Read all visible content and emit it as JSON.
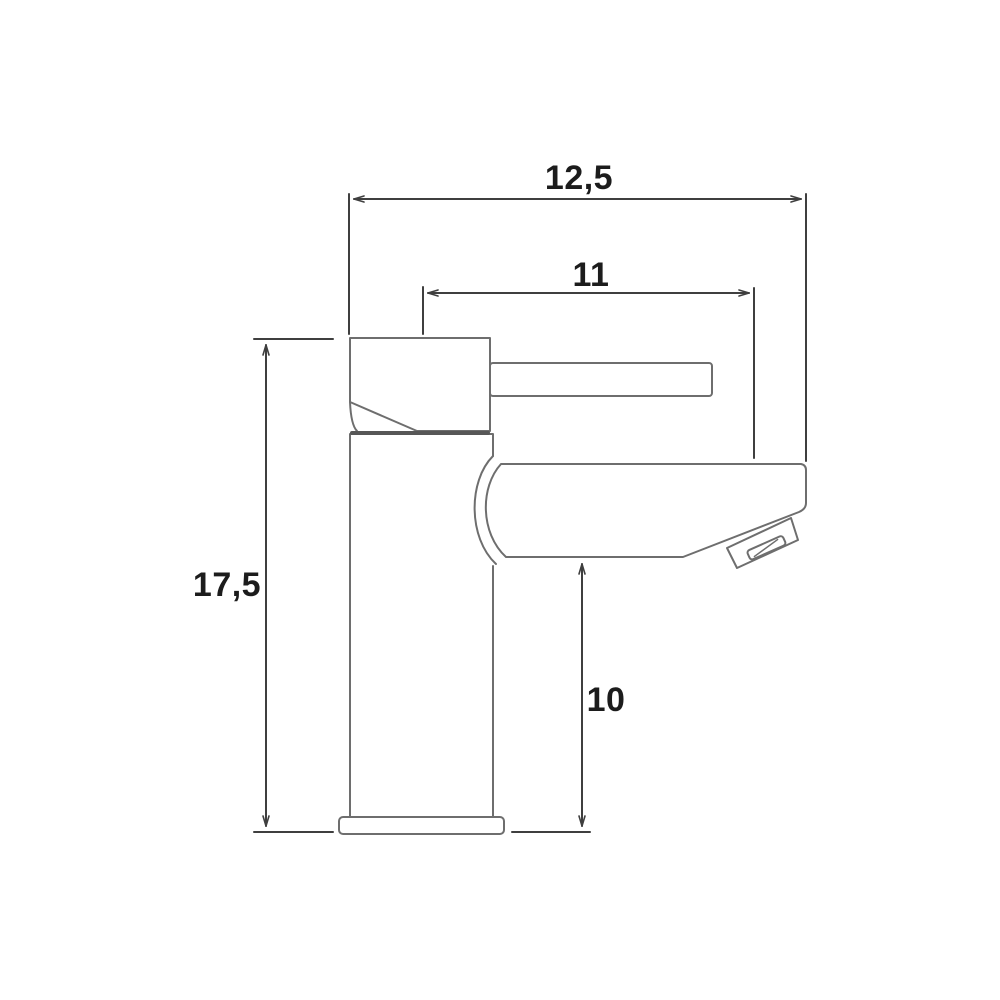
{
  "diagram": {
    "type": "technical-drawing",
    "subject": "single-lever basin mixer tap, side elevation with dimensions",
    "colors": {
      "background": "#ffffff",
      "outline": "#6e6e6e",
      "junction": "#575757",
      "dimension": "#3f3f3f",
      "text": "#1c1c1c"
    },
    "dimensions": {
      "total_width": {
        "label": "12,5",
        "value": 12.5
      },
      "spout_reach": {
        "label": "11",
        "value": 11
      },
      "total_height": {
        "label": "17,5",
        "value": 17.5
      },
      "spout_clearance": {
        "label": "10",
        "value": 10
      }
    }
  }
}
